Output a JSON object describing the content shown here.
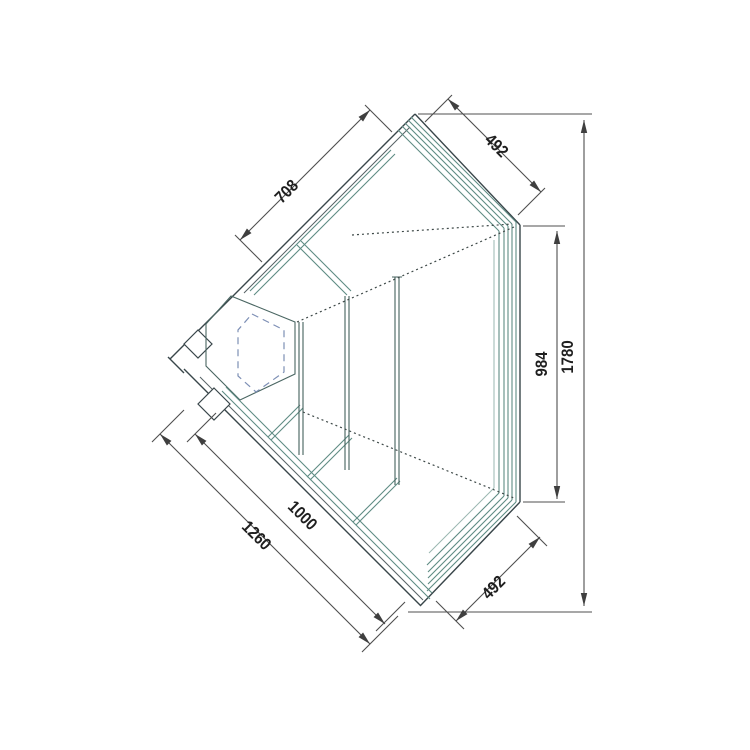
{
  "drawing": {
    "dimension_labels": {
      "back_left": "708",
      "right_top": "492",
      "side_depth": "984",
      "total_depth": "1780",
      "front_outer": "1260",
      "front_glass": "1000",
      "right_bottom": "492"
    },
    "colors": {
      "line_dark": "#39464a",
      "line_teal": "#5f8c84",
      "line_teal_light": "#9ab7b1",
      "line_dim": "#4f4f4f",
      "hidden_dashed": "#7d8fb5",
      "label_text": "#1f1f1f",
      "background": "#ffffff"
    }
  }
}
